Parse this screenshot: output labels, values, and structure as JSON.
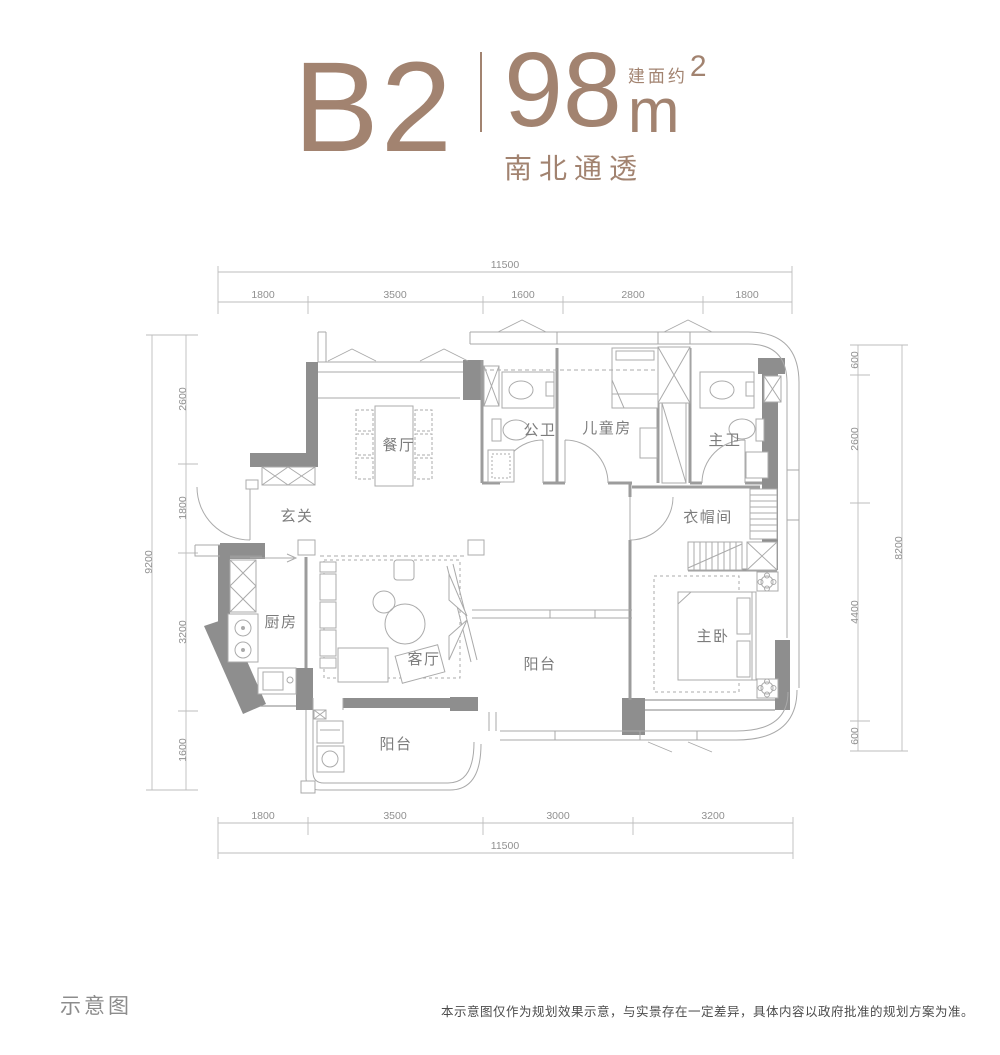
{
  "header": {
    "unit_name": "B2",
    "area_number": "98",
    "area_prefix": "建面约",
    "area_unit": "m",
    "area_sup": "2",
    "subtitle": "南北通透"
  },
  "colors": {
    "accent": "#a28370",
    "wall": "#8e8e8e",
    "line": "#a9a9a9",
    "dim_text": "#909090"
  },
  "floorplan": {
    "rooms": [
      {
        "label": "餐厅"
      },
      {
        "label": "公卫"
      },
      {
        "label": "儿童房"
      },
      {
        "label": "主卫"
      },
      {
        "label": "玄关"
      },
      {
        "label": "衣帽间"
      },
      {
        "label": "厨房"
      },
      {
        "label": "客厅"
      },
      {
        "label": "阳台"
      },
      {
        "label": "主卧"
      },
      {
        "label": "阳台"
      }
    ],
    "dimensions": {
      "top": {
        "total": "11500",
        "segments": [
          "1800",
          "3500",
          "1600",
          "2800",
          "1800"
        ]
      },
      "bottom": {
        "total": "11500",
        "segments": [
          "1800",
          "3500",
          "3000",
          "3200"
        ]
      },
      "left": {
        "total": "9200",
        "segments": [
          "2600",
          "1800",
          "3200",
          "1600"
        ]
      },
      "right": {
        "total": "8200",
        "segments": [
          "600",
          "2600",
          "4400",
          "600"
        ]
      }
    }
  },
  "footer": {
    "caption": "示意图",
    "disclaimer": "本示意图仅作为规划效果示意，与实景存在一定差异，具体内容以政府批准的规划方案为准。"
  }
}
